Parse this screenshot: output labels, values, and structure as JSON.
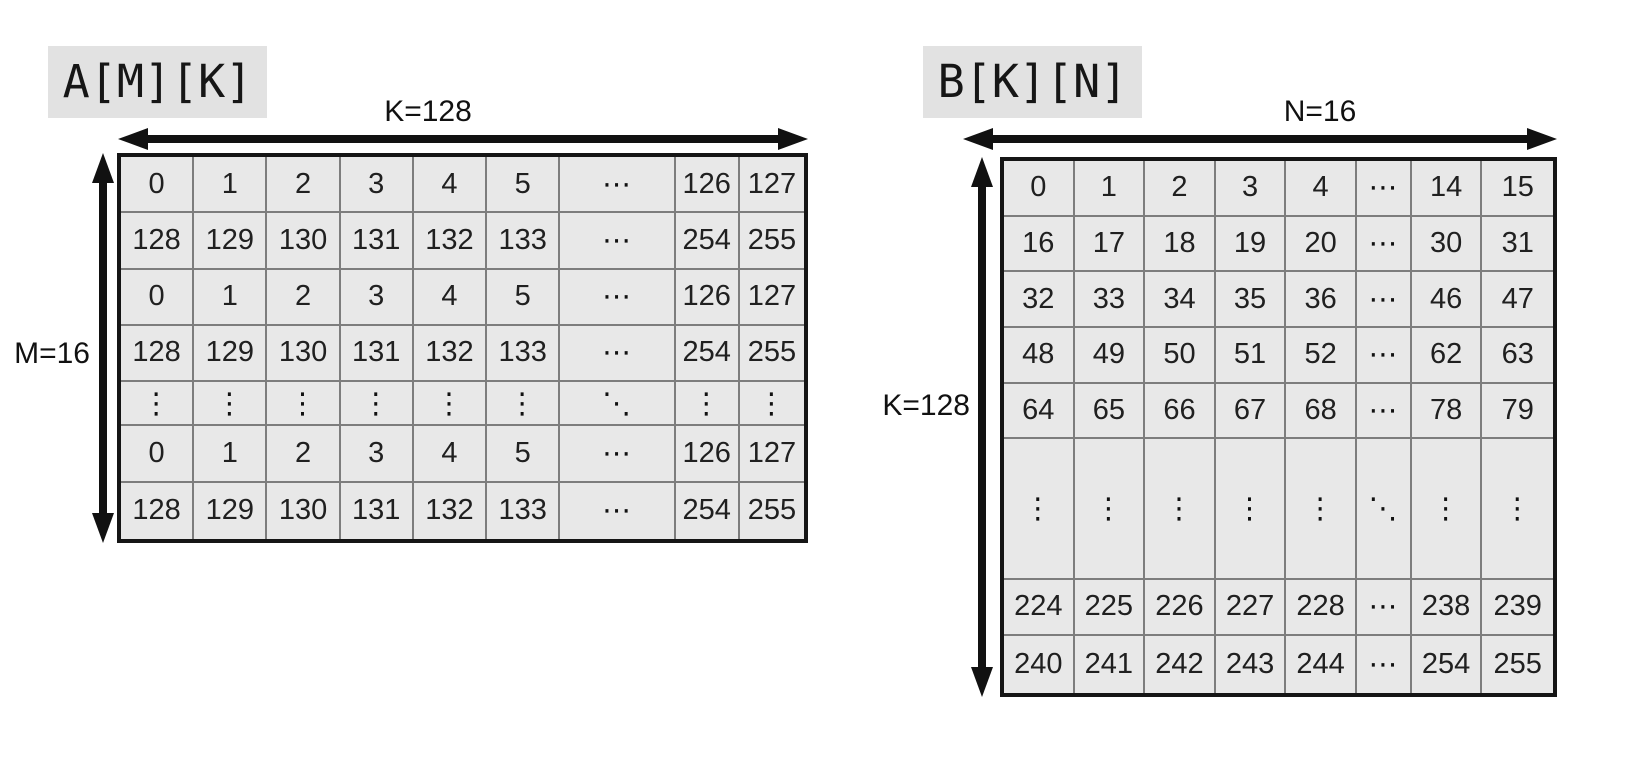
{
  "colors": {
    "cell_background": "#e8e8e8",
    "title_background": "#e2e2e2",
    "grid_line": "#7d7d7d",
    "outer_border": "#151515",
    "arrow": "#111111",
    "text": "#202020"
  },
  "matrices": {
    "a": {
      "title": "A[M][K]",
      "col_label": "K=128",
      "row_label": "M=16",
      "rows": [
        [
          "0",
          "1",
          "2",
          "3",
          "4",
          "5",
          "⋯",
          "126",
          "127"
        ],
        [
          "128",
          "129",
          "130",
          "131",
          "132",
          "133",
          "⋯",
          "254",
          "255"
        ],
        [
          "0",
          "1",
          "2",
          "3",
          "4",
          "5",
          "⋯",
          "126",
          "127"
        ],
        [
          "128",
          "129",
          "130",
          "131",
          "132",
          "133",
          "⋯",
          "254",
          "255"
        ],
        [
          "⋮",
          "⋮",
          "⋮",
          "⋮",
          "⋮",
          "⋮",
          "⋱",
          "⋮",
          "⋮"
        ],
        [
          "0",
          "1",
          "2",
          "3",
          "4",
          "5",
          "⋯",
          "126",
          "127"
        ],
        [
          "128",
          "129",
          "130",
          "131",
          "132",
          "133",
          "⋯",
          "254",
          "255"
        ]
      ]
    },
    "b": {
      "title": "B[K][N]",
      "col_label": "N=16",
      "row_label": "K=128",
      "rows": [
        [
          "0",
          "1",
          "2",
          "3",
          "4",
          "⋯",
          "14",
          "15"
        ],
        [
          "16",
          "17",
          "18",
          "19",
          "20",
          "⋯",
          "30",
          "31"
        ],
        [
          "32",
          "33",
          "34",
          "35",
          "36",
          "⋯",
          "46",
          "47"
        ],
        [
          "48",
          "49",
          "50",
          "51",
          "52",
          "⋯",
          "62",
          "63"
        ],
        [
          "64",
          "65",
          "66",
          "67",
          "68",
          "⋯",
          "78",
          "79"
        ],
        [
          "⋮",
          "⋮",
          "⋮",
          "⋮",
          "⋮",
          "⋱",
          "⋮",
          "⋮"
        ],
        [
          "224",
          "225",
          "226",
          "227",
          "228",
          "⋯",
          "238",
          "239"
        ],
        [
          "240",
          "241",
          "242",
          "243",
          "244",
          "⋯",
          "254",
          "255"
        ]
      ]
    }
  }
}
